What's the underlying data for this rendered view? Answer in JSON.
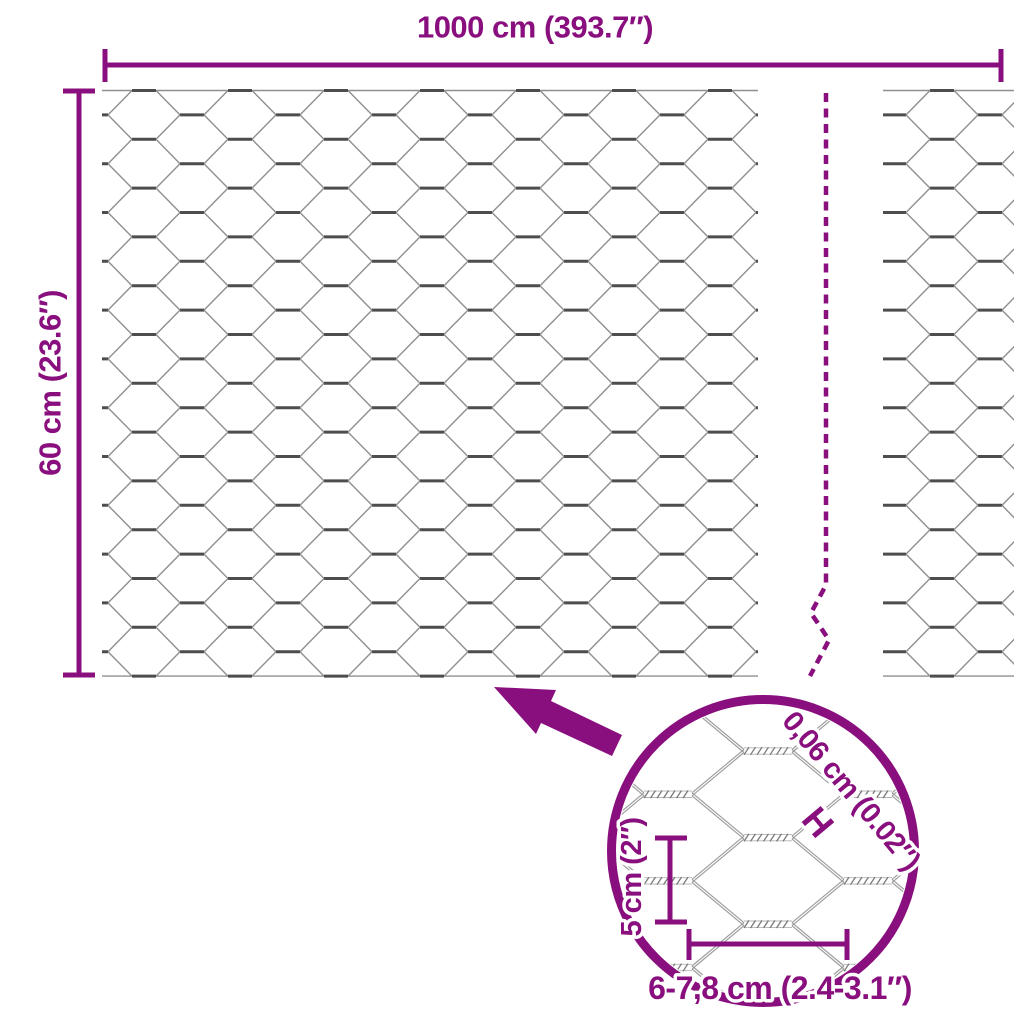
{
  "colors": {
    "accent": "#8A0F7E",
    "wire": "#8F8F8F",
    "wire_dark": "#4D4D4D",
    "background": "#FFFFFF"
  },
  "labels": {
    "total_width": "1000 cm (393.7″)",
    "total_height": "60 cm (23.6″)"
  },
  "magnifier": {
    "wire_thickness": "0,06 cm (0.02″)",
    "thickness_marker": "H",
    "cell_height": "5 cm (2″)",
    "cell_width": "6-7,8 cm (2.4-3.1″)"
  }
}
